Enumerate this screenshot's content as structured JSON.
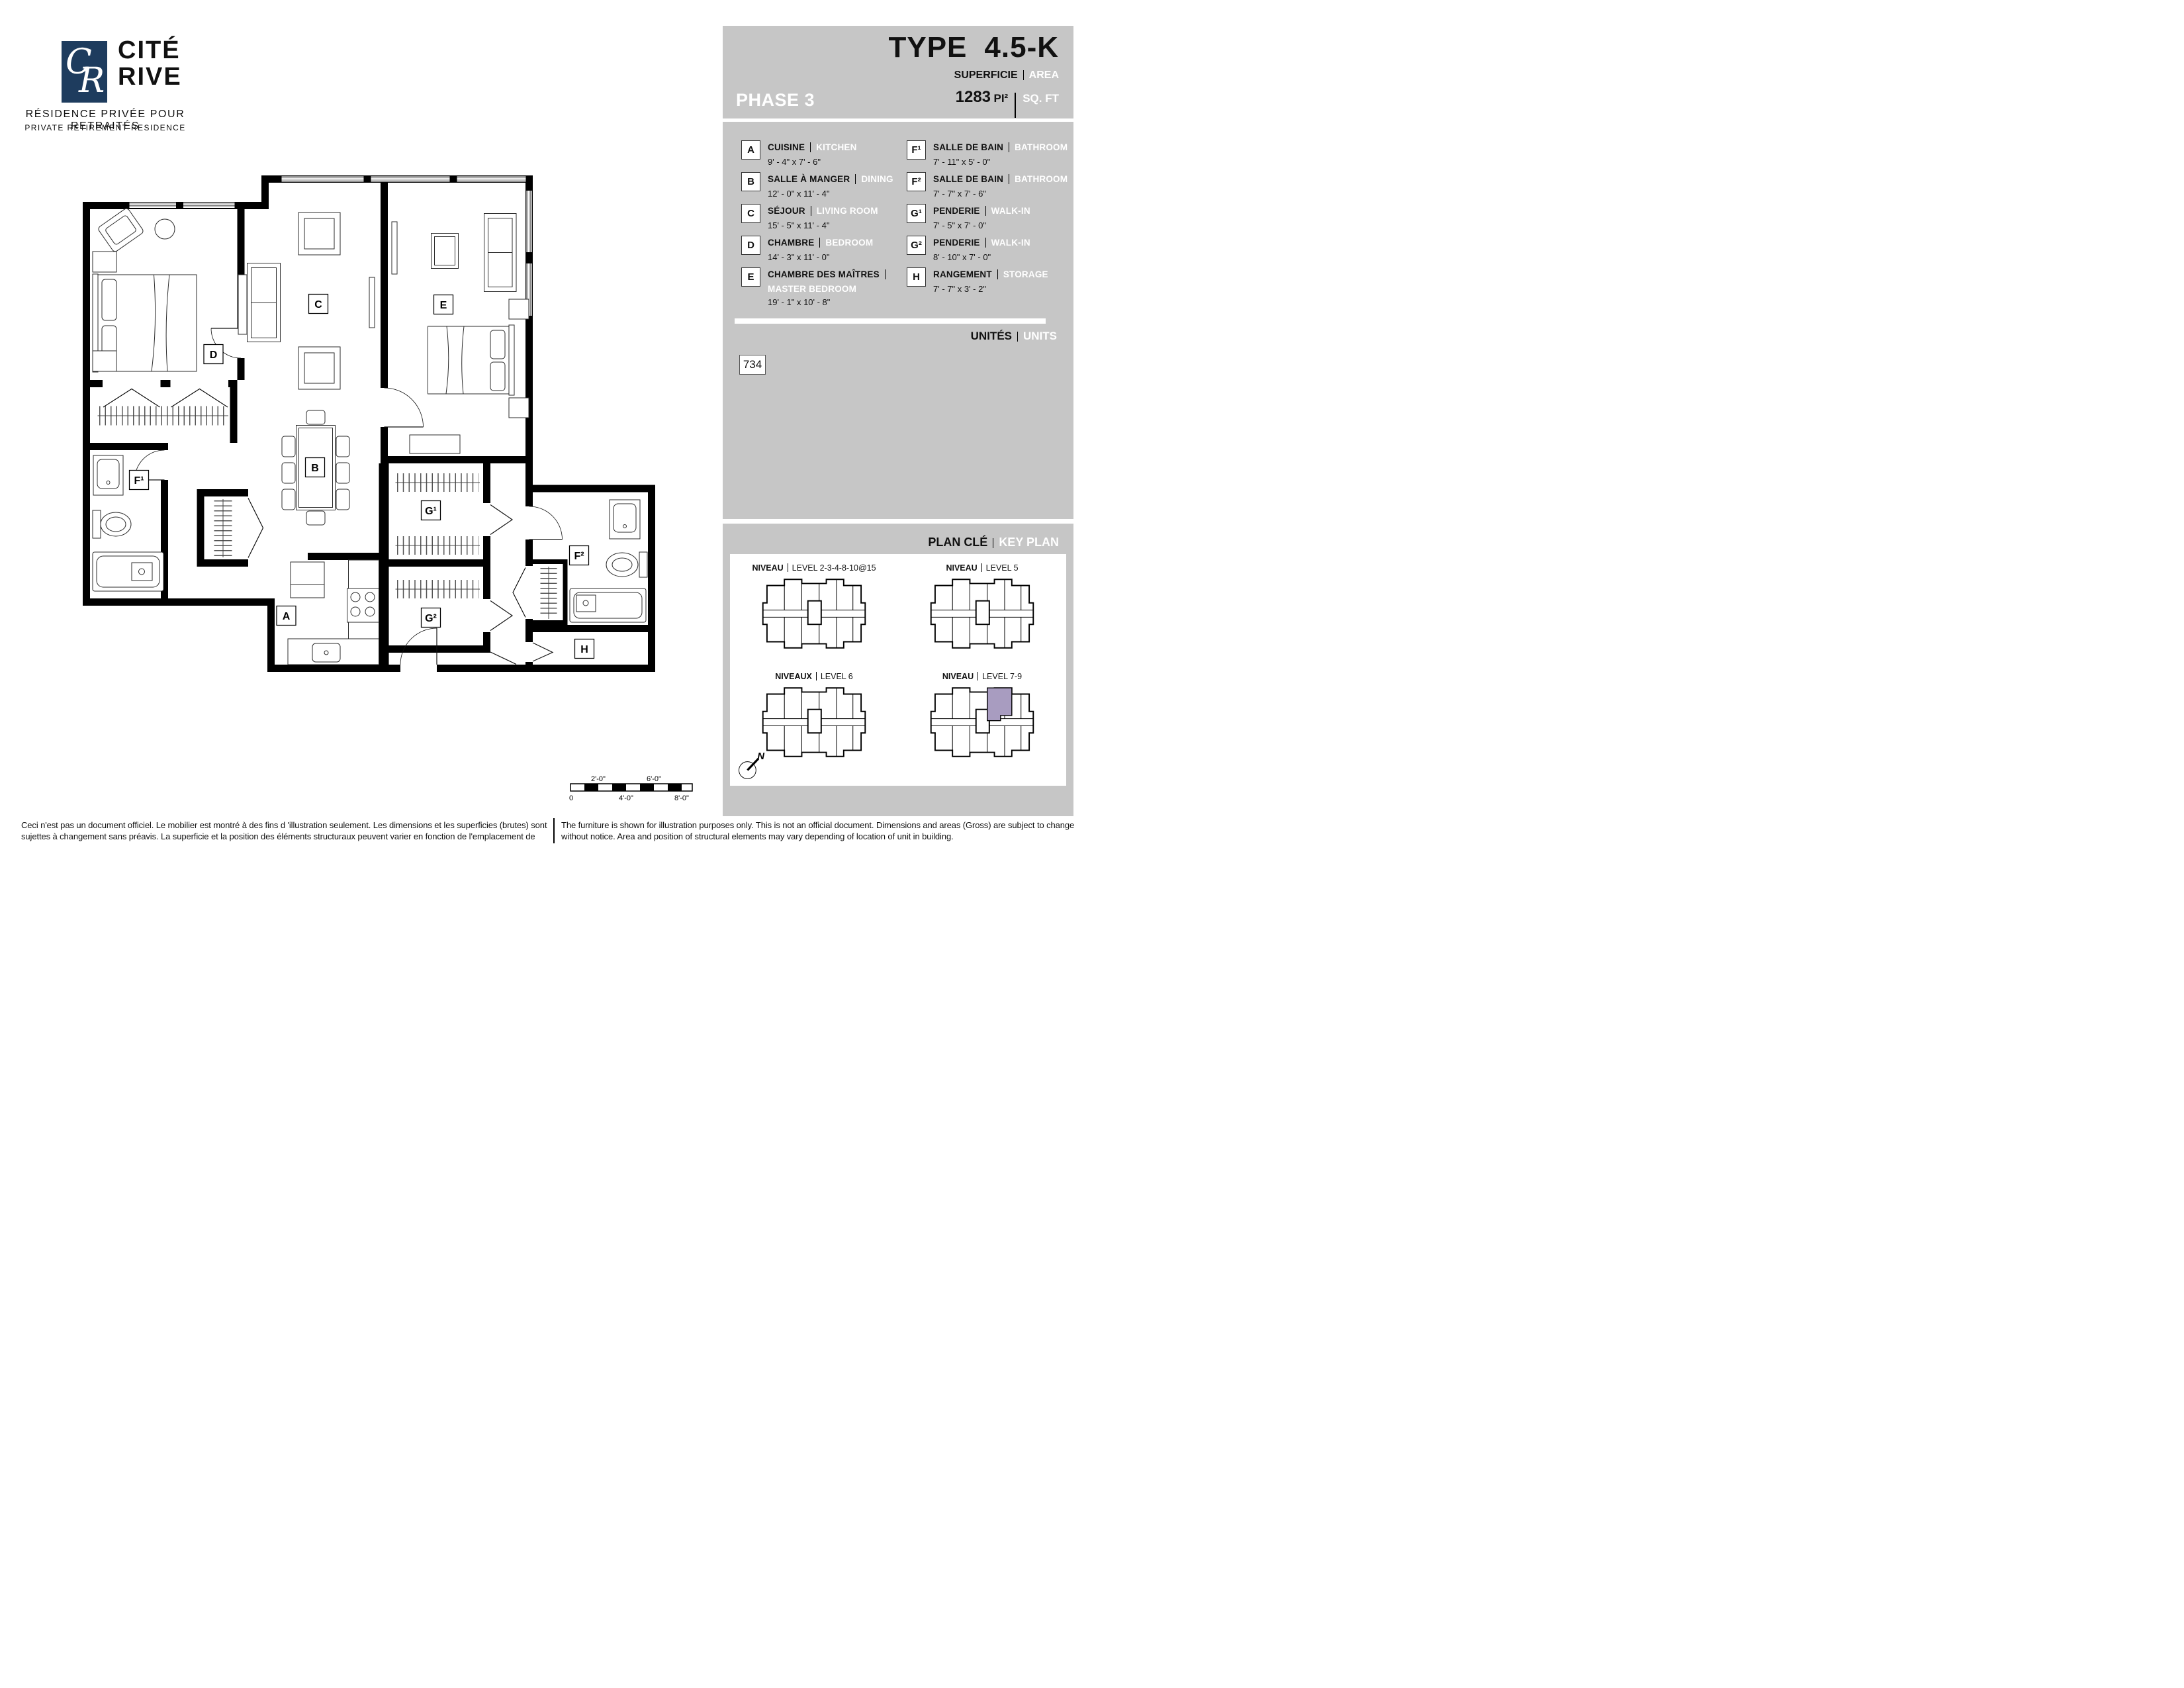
{
  "colors": {
    "panel_gray": "#c6c6c6",
    "logo_navy": "#1e3c5e",
    "highlight_purple": "#a89cc0",
    "wall": "#000000"
  },
  "logo": {
    "monogram_c": "C",
    "monogram_r": "R",
    "brand_line1": "CITÉ",
    "brand_line2": "RIVE",
    "tagline_fr": "RÉSIDENCE PRIVÉE POUR RETRAITÉS",
    "tagline_en": "PRIVATE RETIREMENT RESIDENCE"
  },
  "header": {
    "phase": "PHASE 3",
    "type_label": "TYPE",
    "type_value": "4.5-K",
    "superficie_fr": "SUPERFICIE",
    "superficie_en": "AREA",
    "area_value": "1283",
    "area_unit_fr": "PI²",
    "area_unit_en": "SQ. FT"
  },
  "legend": {
    "left": [
      {
        "id": "A",
        "fr": "CUISINE",
        "en": "KITCHEN",
        "dims": "9' - 4\" x 7' - 6\""
      },
      {
        "id": "B",
        "fr": "SALLE À MANGER",
        "en": "DINING",
        "dims": "12' - 0\" x 11' - 4\""
      },
      {
        "id": "C",
        "fr": "SÉJOUR",
        "en": "LIVING ROOM",
        "dims": "15' - 5\" x 11' - 4\""
      },
      {
        "id": "D",
        "fr": "CHAMBRE",
        "en": "BEDROOM",
        "dims": "14' - 3\" x 11' - 0\""
      },
      {
        "id": "E",
        "fr": "CHAMBRE DES MAÎTRES",
        "en": "MASTER BEDROOM",
        "dims": "19' - 1\" x 10' - 8\""
      }
    ],
    "right": [
      {
        "id": "F¹",
        "fr": "SALLE DE BAIN",
        "en": "BATHROOM",
        "dims": "7' - 11\" x 5' - 0\""
      },
      {
        "id": "F²",
        "fr": "SALLE DE BAIN",
        "en": "BATHROOM",
        "dims": "7' - 7\" x 7' - 6\""
      },
      {
        "id": "G¹",
        "fr": "PENDERIE",
        "en": "WALK-IN",
        "dims": "7' - 5\" x 7' - 0\""
      },
      {
        "id": "G²",
        "fr": "PENDERIE",
        "en": "WALK-IN",
        "dims": "8' - 10\" x 7' - 0\""
      },
      {
        "id": "H",
        "fr": "RANGEMENT",
        "en": "STORAGE",
        "dims": "7' - 7\" x 3' - 2\""
      }
    ]
  },
  "units": {
    "fr": "UNITÉS",
    "en": "UNITS",
    "value": "734"
  },
  "key_plan": {
    "fr": "PLAN CLÉ",
    "en": "KEY PLAN",
    "plans": [
      {
        "fr": "NIVEAU",
        "en": "LEVEL 2-3-4-8-10@15",
        "highlight": false
      },
      {
        "fr": "NIVEAU",
        "en": "LEVEL 5",
        "highlight": false
      },
      {
        "fr": "NIVEAUX",
        "en": "LEVEL 6",
        "highlight": false
      },
      {
        "fr": "NIVEAU",
        "en": "LEVEL 7-9",
        "highlight": true
      }
    ]
  },
  "floor_plan": {
    "labels": [
      "A",
      "B",
      "C",
      "D",
      "E",
      "F¹",
      "F²",
      "G¹",
      "G²",
      "H"
    ],
    "north": "N"
  },
  "scale_bar": {
    "above": [
      "2'-0\"",
      "6'-0\""
    ],
    "below": [
      "0",
      "4'-0\"",
      "8'-0\""
    ]
  },
  "footer": {
    "fr": "Ceci n'est pas un document officiel.  Le mobilier est montré à des fins d 'illustration seulement.  Les dimensions et les superficies (brutes) sont sujettes à changement sans préavis. La superficie et la position des éléments structuraux peuvent varier en fonction de l'emplacement de l'unité dans le bâtiment.",
    "en": "The furniture is shown for illustration purposes only.  This is not an official document.  Dimensions and areas (Gross) are subject to change without notice.  Area and position of structural elements may vary depending of location of unit in building."
  }
}
